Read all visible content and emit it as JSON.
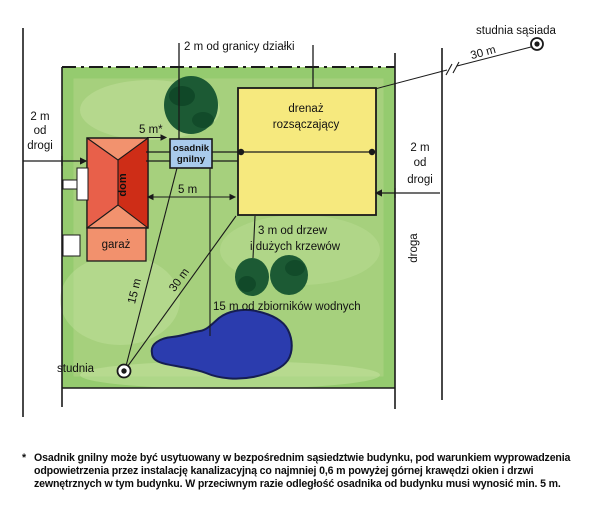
{
  "colors": {
    "plot_green": "#a6d07d",
    "plot_green_edge": "#8cc768",
    "plot_green_light": "#c8e3a2",
    "drain_yellow": "#f6e97e",
    "tank_blue": "#a9cbec",
    "tank_text": "#16275c",
    "roof_light": "#f2926e",
    "roof_mid": "#e8604a",
    "roof_dark": "#ce2d17",
    "garage_fill": "#f2916d",
    "tree_green": "#1c5a34",
    "tree_dark": "#0e4426",
    "pond_blue": "#2b3cae",
    "pond_edge": "#151d52",
    "line": "#1a1a1a",
    "white": "#ffffff"
  },
  "annotations": {
    "boundary_dist": "2 m od granicy działki",
    "neighbor_well_label": "studnia sąsiada",
    "neighbor_well_dist": "30 m",
    "road_left": [
      "2 m",
      "od",
      "drogi"
    ],
    "road_right": [
      "2 m",
      "od",
      "drogi"
    ],
    "road_vertical": "droga",
    "drain_field": [
      "drenaż",
      "rozsączający"
    ],
    "septic_tank": [
      "osadnik",
      "gnilny"
    ],
    "house": "dom",
    "garage": "garaż",
    "house_tank_dist": "5 m*",
    "house_drain_dist": "5 m",
    "trees_dist": [
      "3 m od drzew",
      "i dużych krzewów"
    ],
    "water_dist": "15 m od zbiorników wodnych",
    "well_label": "studnia",
    "well_tank_dist": "15 m",
    "well_drain_dist": "30 m"
  },
  "footnote": {
    "marker": "*",
    "lines": [
      "Osadnik gnilny może być usytuowany w bezpośrednim sąsiedztwie budynku, pod warunkiem wyprowadzenia",
      "odpowietrzenia przez instalację kanalizacyjną co najmniej 0,6 m powyżej górnej krawędzi okien i drzwi",
      "zewnętrznych w tym budynku. W przeciwnym razie odległość osadnika od budynku musi wynosić min. 5 m."
    ]
  }
}
